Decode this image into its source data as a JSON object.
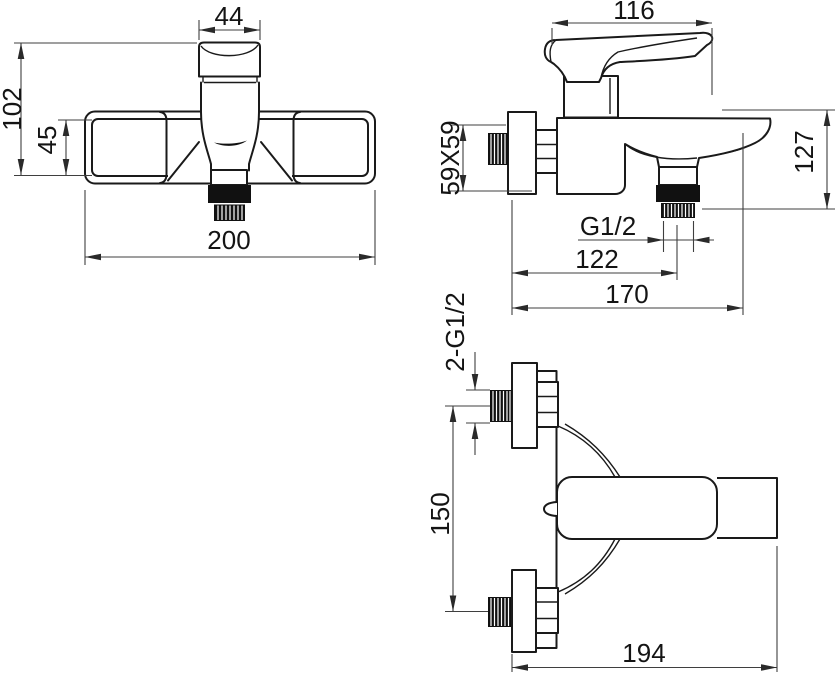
{
  "drawing": {
    "colors": {
      "background": "#ffffff",
      "part_line": "#1a1a1a",
      "dimension_line": "#3f3f3f",
      "text": "#141414"
    },
    "front_view": {
      "spout_width": "44",
      "overall_height": "102",
      "body_height": "45",
      "overall_width": "200"
    },
    "side_view": {
      "handle_length": "116",
      "flange_size": "59X59",
      "overall_height": "127",
      "outlet_thread": "G1/2",
      "wall_to_outlet": "122",
      "wall_to_spout_tip": "170"
    },
    "top_view": {
      "inlet_threads": "2-G1/2",
      "inlet_spacing": "150",
      "overall_depth": "194"
    }
  }
}
